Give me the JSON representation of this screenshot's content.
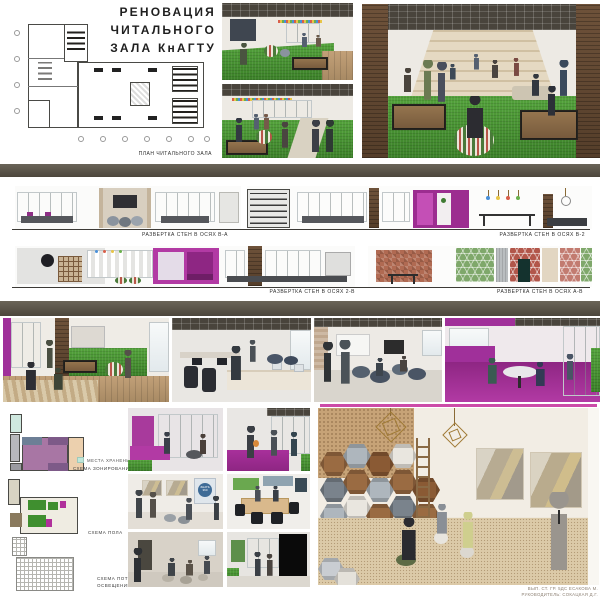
{
  "board": {
    "title": {
      "line1": "РЕНОВАЦИЯ ЧИТАЛЬНОГО",
      "line2": "ЗАЛА КнАГТУ"
    },
    "plan": {
      "caption": "ПЛАН ЧИТАЛЬНОГО ЗАЛА"
    },
    "elevations": [
      {
        "caption": "РАЗВЕРТКА СТЕН В ОСЯХ В-А"
      },
      {
        "caption": "РАЗВЕРТКА СТЕН В ОСЯХ В-2"
      },
      {
        "caption": "РАЗВЕРТКА СТЕН В ОСЯХ 2-В"
      },
      {
        "caption": "РАЗВЕРТКА СТЕН В ОСЯХ А-В"
      }
    ],
    "schemes": {
      "storage_legend": "МЕСТА ХРАНЕНИЯ",
      "zoning_caption": "СХЕМА ЗОНИРОВАНИЯ",
      "floor_caption": "СХЕМА ПОЛА",
      "ceiling_caption_line1": "СХЕМА ПОТОЛКА/",
      "ceiling_caption_line2": "ОСВЕЩЕНИЕ"
    },
    "wall_sign": {
      "line1": "ЗНАТЬ",
      "line2": "360"
    },
    "credits": {
      "line1": "ВЫП. СТ. ГР. 5ДС ЕСАКОВА М.",
      "line2": "РУКОВОДИТЕЛЬ: СОКАЦКАЯ Д.Г."
    },
    "colors": {
      "accent_magenta": "#a8309b",
      "grass_green": "#44962f",
      "divider_olive": "#57524a",
      "wood_brown": "#8a6544",
      "legend_mint": "#bfe7da"
    }
  }
}
